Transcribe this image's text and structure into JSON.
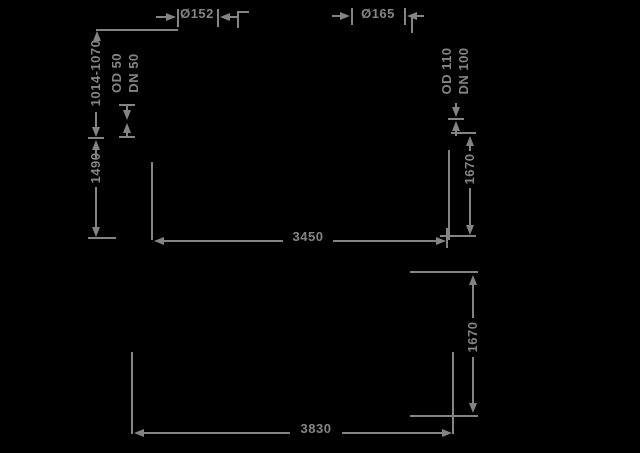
{
  "drawing": {
    "background": "#000000",
    "ink": "#848484",
    "views": {
      "upper": {
        "left_connection": {
          "diameter": "Ø152",
          "height_range": "1014-1070",
          "pipe_od": "OD 50",
          "pipe_dn": "DN 50"
        },
        "right_connection": {
          "diameter": "Ø165",
          "pipe_od": "OD 110",
          "pipe_dn": "DN 100"
        },
        "height_left": "1490",
        "height_right": "1670",
        "width": "3450"
      },
      "lower": {
        "height_right": "1670",
        "width": "3830"
      }
    }
  }
}
